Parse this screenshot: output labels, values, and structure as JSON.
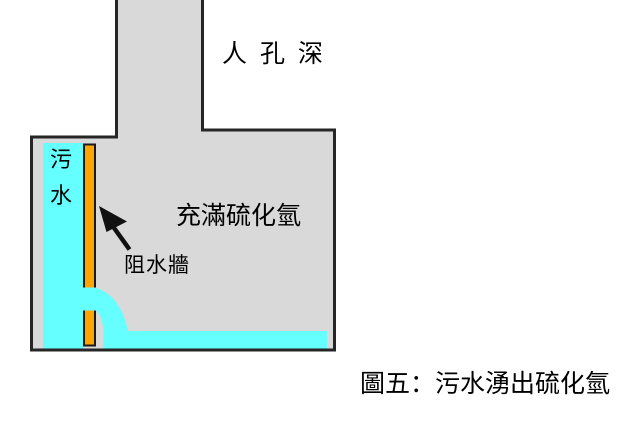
{
  "figure": {
    "shaft_label": "人孔深",
    "chamber_label": "充滿硫化氫",
    "wall_label": "阻水牆",
    "sewage_chars": [
      "污",
      "水"
    ],
    "caption": "圖五：污水湧出硫化氫",
    "colors": {
      "structure_fill": "#d9d9d9",
      "water": "#66ffff",
      "wall": "#ffa500",
      "outline": "#262626",
      "arrow": "#111111",
      "text": "#000000"
    }
  }
}
